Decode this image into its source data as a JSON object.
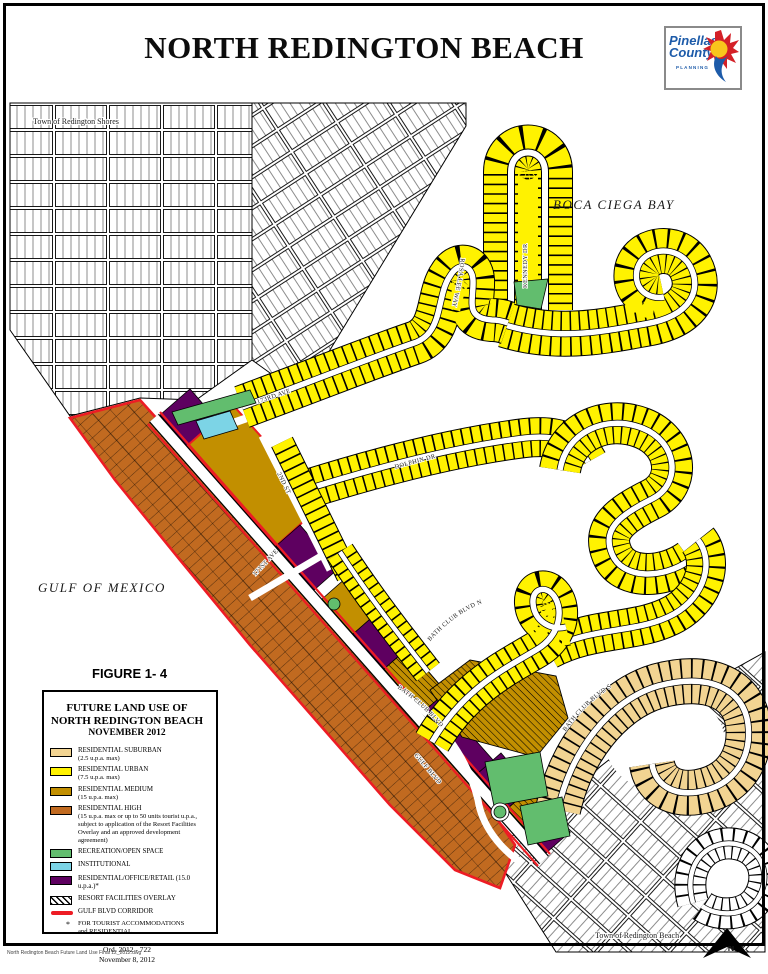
{
  "page": {
    "title": "NORTH REDINGTON BEACH",
    "file_note": "North Redington Beach Future Land Use Final 12_2012.dwg"
  },
  "logo": {
    "line1": "Pinellas",
    "line2": "County",
    "line3": "PLANNING"
  },
  "figure_label": "FIGURE 1- 4",
  "map": {
    "labels": {
      "town_north": "Town of Redington Shores",
      "town_south": "Town of Redington Beach",
      "bay": "BOCA CIEGA BAY",
      "gulf": "GULF OF MEXICO",
      "north_arrow": "N"
    },
    "streets": {
      "kennedy": "KENNEDY DR",
      "rosalee": "ROSA LEE  WAY",
      "dolphin": "DOLPHIN DR",
      "ave173": "173RD AVE",
      "st2": "2ND ST",
      "ave171": "171ST AVE",
      "bathclub_n": "BATH  CLUB  BLVD  N",
      "bathclub_s": "BATH  CLUB  BLVD  S",
      "bathclub_w": "BATH  CLUB  BLVD",
      "gulfblvd": "GULF BLVD"
    }
  },
  "legend": {
    "title_line1": "FUTURE LAND USE OF",
    "title_line2": "NORTH REDINGTON BEACH",
    "title_line3": "NOVEMBER 2012",
    "items": [
      {
        "label": "RESIDENTIAL SUBURBAN",
        "sublabel": "(2.5 u.p.a. max)",
        "color": "#f2d492"
      },
      {
        "label": "RESIDENTIAL URBAN",
        "sublabel": "(7.5 u.p.a. max)",
        "color": "#fff200"
      },
      {
        "label": "RESIDENTIAL MEDIUM",
        "sublabel": "(15 u.p.a. max)",
        "color": "#c28f00"
      },
      {
        "label": "RESIDENTIAL HIGH",
        "sublabel": "(15 u.p.a. max or up to 50 units tourist u.p.a., subject to application of the Resort Facilities Overlay and an approved development agreement)",
        "color": "#c16a20"
      },
      {
        "label": "RECREATION/OPEN SPACE",
        "sublabel": "",
        "color": "#62bd6e"
      },
      {
        "label": "INSTITUTIONAL",
        "sublabel": "",
        "color": "#7cd4e6"
      },
      {
        "label": "RESIDENTIAL/OFFICE/RETAIL (15.0 u.p.a.)*",
        "sublabel": "",
        "color": "#5e0060"
      },
      {
        "label": "RESORT FACILITIES OVERLAY",
        "sublabel": "",
        "color": "hatch"
      },
      {
        "label": "GULF BLVD CORRIDOR",
        "sublabel": "FOR TOURIST ACCOMMODATIONS\nand RESIDENTIAL",
        "color": "#ed1c24",
        "asterisk": "*"
      }
    ],
    "ord_line1": "Ord. 2012 - 722",
    "ord_line2": "November 8, 2012"
  },
  "palette": {
    "residential_urban": "#fff200",
    "residential_suburban": "#f2d492",
    "residential_medium": "#c28f00",
    "residential_high": "#c16a20",
    "recreation": "#62bd6e",
    "institutional": "#7cd4e6",
    "office_retail": "#5e0060",
    "corridor_red": "#ed1c24",
    "logo_blue": "#1d5ba9",
    "logo_red": "#d42027",
    "logo_yellow": "#f9c51c"
  }
}
